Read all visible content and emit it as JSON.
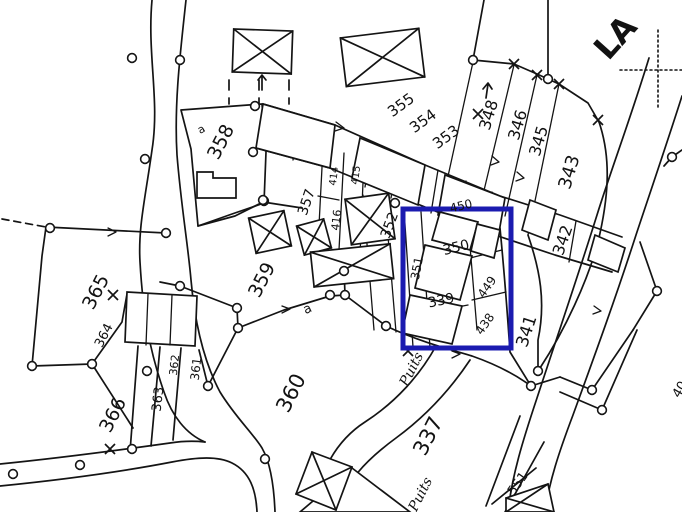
{
  "map": {
    "highlight_color": "#1b1bb0",
    "place_name": "LA",
    "well_label_1": "Puits",
    "well_label_2": "Puits",
    "subdivision_a_1": "a",
    "subdivision_a_2": "a",
    "parcels": {
      "p337": "337",
      "p339": "339",
      "p341": "341",
      "p342": "342",
      "p343": "343",
      "p345": "345",
      "p346": "346",
      "p348": "348",
      "p350": "350",
      "p351": "351",
      "p352": "352",
      "p353": "353",
      "p354": "354",
      "p355": "355",
      "p357": "357",
      "p358": "358",
      "p359": "359",
      "p360": "360",
      "p361": "361",
      "p362": "362",
      "p363": "363",
      "p364": "364",
      "p365": "365",
      "p366": "366",
      "p414": "414",
      "p415": "415",
      "p416": "416",
      "p438": "438",
      "p449": "449",
      "p450": "450",
      "p551": "551",
      "edge_partial": "40"
    }
  }
}
